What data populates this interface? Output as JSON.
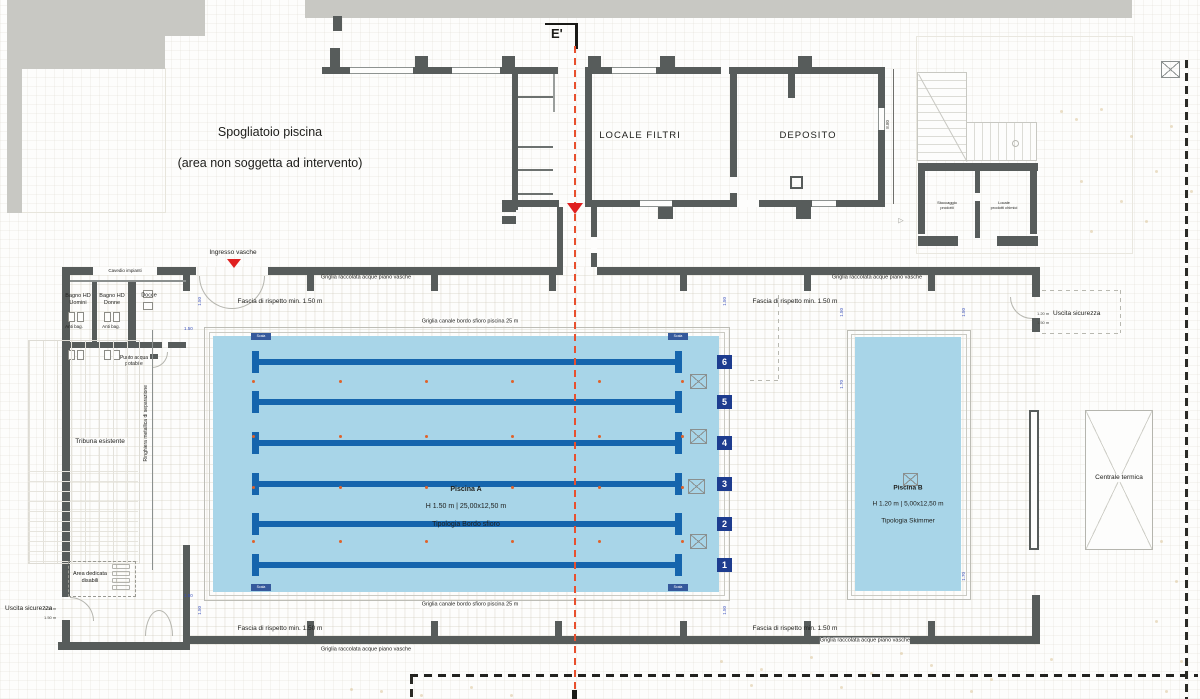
{
  "note": {
    "line1": "Spogliatoio piscina",
    "line2": "(area non soggetta ad intervento)"
  },
  "section_marker": "E'",
  "rooms": {
    "locale_filtri": "LOCALE FILTRI",
    "deposito": "DEPOSITO",
    "stoccaggio": "Stoccaggio\nprodotti",
    "locale_chimici": "Locale\nprodotti chimici",
    "centrale_termica": "Centrale termica",
    "cavedio": "Cavedio impianti",
    "bagno_uomini": "Bagno HD\nUomini",
    "bagno_donne": "Bagno HD\nDonne",
    "docce": "Docce",
    "anti_bag": "Anti bag.",
    "punto_acqua": "Punto acqua\npotabile",
    "tribuna": "Tribuna esistente",
    "ringhiera": "Ringhiera metallica di separazione",
    "area_disabili": "Area dedicata\ndisabili"
  },
  "annotations": {
    "ingresso": "Ingresso vasche",
    "uscita": "Uscita sicurezza",
    "fascia": "Fascia di rispetto min. 1.50 m",
    "griglia_raccolta": "Griglia raccolata acque piano vasche",
    "griglia_canale": "Griglia canale bordo sfioro piscina 25 m"
  },
  "pools": {
    "a": {
      "name": "Piscina A",
      "size": "H 1.50 m | 25,00x12,50 m",
      "type": "Tipologia Bordo sfioro",
      "lanes": [
        "6",
        "5",
        "4",
        "3",
        "2",
        "1"
      ],
      "ladder_label": "Scala"
    },
    "b": {
      "name": "Piscina B",
      "size": "H 1.20 m | 5,00x12,50 m",
      "type": "Tipologia Skimmer"
    }
  },
  "dimensions": {
    "offset": "1.50",
    "depth_b": "1.70",
    "building": "8.80",
    "exit_a": "1.20 m",
    "exit_b": "1.50 m"
  },
  "colors": {
    "water": "#a8d5e8",
    "wall": "#575c5b",
    "lane_rope": "#1565ad",
    "lane_badge": "#1d3c8f",
    "section_line": "#e8502e",
    "marker_dot": "#e0622a"
  }
}
